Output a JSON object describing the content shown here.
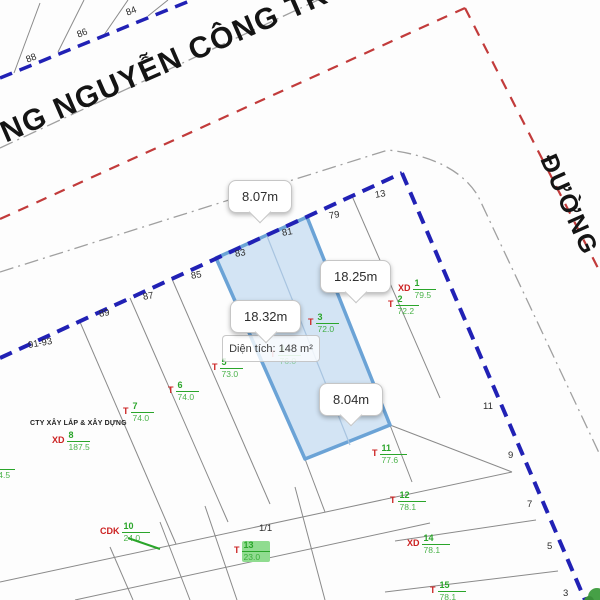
{
  "map": {
    "street_top": "ĐƯỜNG NGUYỄN CÔNG TRỨ",
    "street_right": "ĐƯỜNG",
    "company": "CTY XÂY LẮP & XÂY DỰNG",
    "block_label": "1/1"
  },
  "selected_parcel": {
    "area_label": "Diện tích: 148 m²",
    "width_top": "8.07m",
    "length_right": "18.25m",
    "length_left": "18.32m",
    "width_bottom": "8.04m"
  },
  "house_numbers": [
    "84",
    "86",
    "88",
    "91-93",
    "89",
    "87",
    "85",
    "83",
    "81",
    "79",
    "13",
    "11",
    "9",
    "7",
    "5",
    "3"
  ],
  "lots": [
    {
      "prefix": "XD",
      "num": "1",
      "area": "79.5"
    },
    {
      "prefix": "T",
      "num": "2",
      "area": "72.2"
    },
    {
      "prefix": "T",
      "num": "3",
      "area": "72.0"
    },
    {
      "prefix": "T",
      "num": "4",
      "area": "76.0"
    },
    {
      "prefix": "T",
      "num": "5",
      "area": "73.0"
    },
    {
      "prefix": "T",
      "num": "6",
      "area": "74.0"
    },
    {
      "prefix": "T",
      "num": "7",
      "area": "74.0"
    },
    {
      "prefix": "XD",
      "num": "8",
      "area": "187.5"
    },
    {
      "prefix": "T",
      "num": "9",
      "area": "74.5"
    },
    {
      "prefix": "CDK",
      "num": "10",
      "area": "24.0"
    },
    {
      "prefix": "T",
      "num": "11",
      "area": "77.6"
    },
    {
      "prefix": "T",
      "num": "12",
      "area": "78.1"
    },
    {
      "prefix": "T",
      "num": "13",
      "area": "23.0"
    },
    {
      "prefix": "XD",
      "num": "14",
      "area": "78.1"
    },
    {
      "prefix": "T",
      "num": "15",
      "area": "78.1"
    }
  ],
  "colors": {
    "boundary_blue": "#2121b5",
    "street_red": "#c23b3b",
    "centerline_gray": "#a0a0a0",
    "lot_line_gray": "#8a8a8a",
    "parcel_fill": "#c9def2",
    "parcel_stroke": "#6ba3d6",
    "label_green": "#2aa52a",
    "label_red": "#cc2222"
  }
}
